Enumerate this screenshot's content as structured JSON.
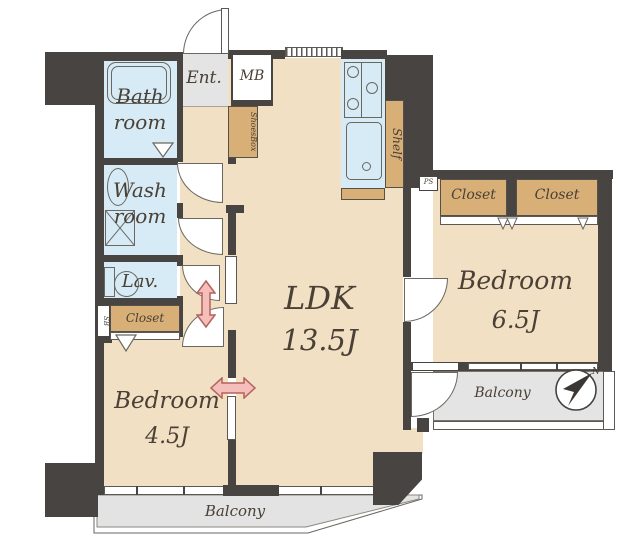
{
  "title": "Apartment floor plan",
  "colors": {
    "wall": "#474442",
    "floor": "#f1e0c3",
    "cabinet": "#d8af76",
    "wet_area": "#d6ebf5",
    "gray_area": "#e4e4e4",
    "arrow_fill": "#f5beba",
    "arrow_outline": "#b2625d",
    "text": "#4a4036"
  },
  "rooms": {
    "bath": {
      "line1": "Bath",
      "line2": "room"
    },
    "wash": {
      "line1": "Wash",
      "line2": "room"
    },
    "lav": {
      "label": "Lav."
    },
    "hall_closet": {
      "label": "Closet"
    },
    "sb": {
      "label": "SB"
    },
    "entrance": {
      "label": "Ent."
    },
    "meter_box": {
      "label": "MB"
    },
    "shoes_box": {
      "label": "ShoesBox"
    },
    "shelf": {
      "label": "Shelf"
    },
    "pipe_space": {
      "label": "PS"
    },
    "ldk": {
      "label": "LDK",
      "size": "13.5J"
    },
    "bedroom_45": {
      "label": "Bedroom",
      "size": "4.5J"
    },
    "bedroom_65": {
      "label": "Bedroom",
      "size": "6.5J"
    },
    "closet_a": {
      "label": "Closet"
    },
    "closet_b": {
      "label": "Closet"
    },
    "balcony_bottom": {
      "label": "Balcony"
    },
    "balcony_right": {
      "label": "Balcony"
    }
  },
  "compass": {
    "north": "N"
  }
}
